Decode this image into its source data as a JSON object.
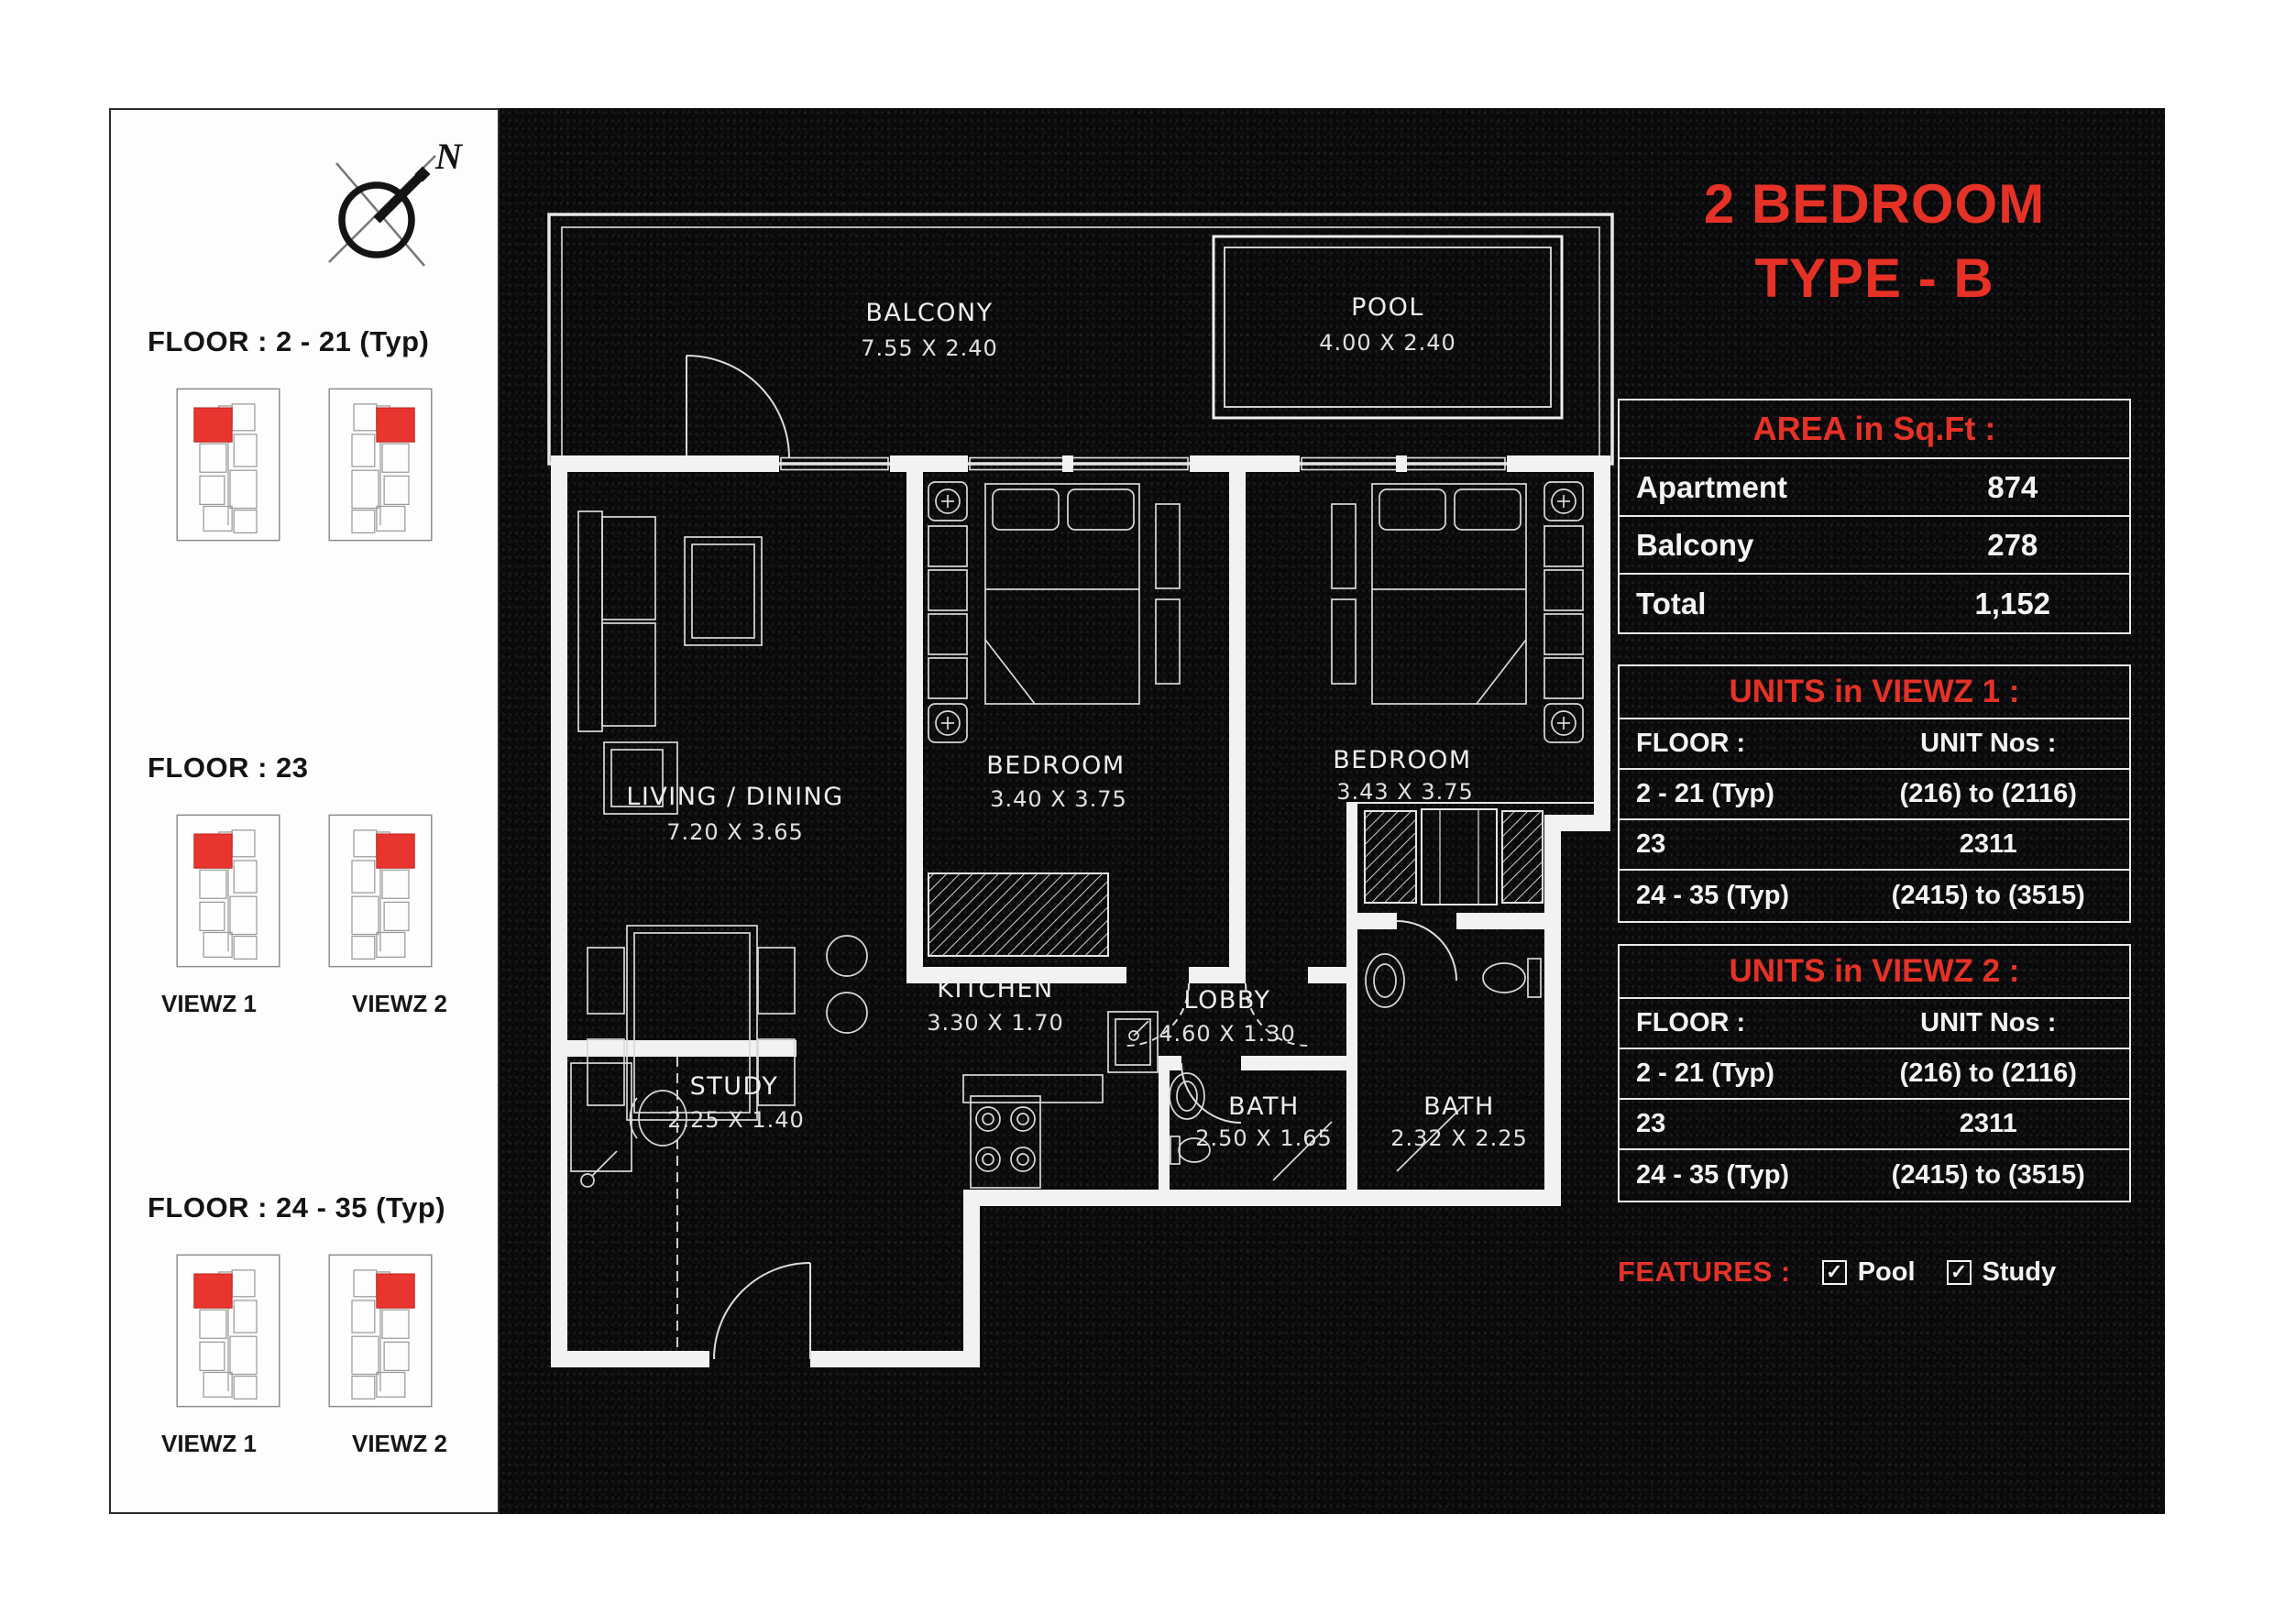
{
  "title": {
    "line1": "2 BEDROOM",
    "line2": "TYPE - B"
  },
  "area_table": {
    "header": "AREA in Sq.Ft :",
    "rows": [
      {
        "label": "Apartment",
        "value": "874"
      },
      {
        "label": "Balcony",
        "value": "278"
      },
      {
        "label": "Total",
        "value": "1,152"
      }
    ]
  },
  "units_viewz1": {
    "header": "UNITS in VIEWZ 1 :",
    "col_floor": "FLOOR :",
    "col_units": "UNIT Nos :",
    "rows": [
      {
        "floor": "2 - 21 (Typ)",
        "units": "(216) to (2116)"
      },
      {
        "floor": "23",
        "units": "2311"
      },
      {
        "floor": "24 - 35 (Typ)",
        "units": "(2415) to (3515)"
      }
    ]
  },
  "units_viewz2": {
    "header": "UNITS in VIEWZ 2 :",
    "col_floor": "FLOOR :",
    "col_units": "UNIT Nos :",
    "rows": [
      {
        "floor": "2 - 21 (Typ)",
        "units": "(216) to (2116)"
      },
      {
        "floor": "23",
        "units": "2311"
      },
      {
        "floor": "24 - 35 (Typ)",
        "units": "(2415) to (3515)"
      }
    ]
  },
  "features": {
    "label": "FEATURES :",
    "items": [
      {
        "label": "Pool"
      },
      {
        "label": "Study"
      }
    ]
  },
  "icons": {
    "checkbox": "✓"
  },
  "sidebar": {
    "north_label": "N",
    "groups": [
      {
        "label": "FLOOR : 2 - 21 (Typ)"
      },
      {
        "label": "FLOOR : 23",
        "captions": [
          "VIEWZ 1",
          "VIEWZ 2"
        ]
      },
      {
        "label": "FLOOR : 24 - 35 (Typ)",
        "captions": [
          "VIEWZ 1",
          "VIEWZ 2"
        ]
      }
    ]
  },
  "plan": {
    "rooms": {
      "balcony": {
        "name": "BALCONY",
        "dims": "7.55 X 2.40"
      },
      "pool": {
        "name": "POOL",
        "dims": "4.00 X 2.40"
      },
      "bedroom1": {
        "name": "BEDROOM",
        "dims": "3.40 X 3.75"
      },
      "bedroom2": {
        "name": "BEDROOM",
        "dims": "3.43 X 3.75"
      },
      "living": {
        "name": "LIVING / DINING",
        "dims": "7.20 X 3.65"
      },
      "lobby": {
        "name": "LOBBY",
        "dims": "4.60 X 1.30"
      },
      "kitchen": {
        "name": "KITCHEN",
        "dims": "3.30 X 1.70"
      },
      "bath1": {
        "name": "BATH",
        "dims": "2.50 X 1.65"
      },
      "bath2": {
        "name": "BATH",
        "dims": "2.32 X 2.25"
      },
      "study": {
        "name": "STUDY",
        "dims": "2.25 X 1.40"
      }
    }
  }
}
